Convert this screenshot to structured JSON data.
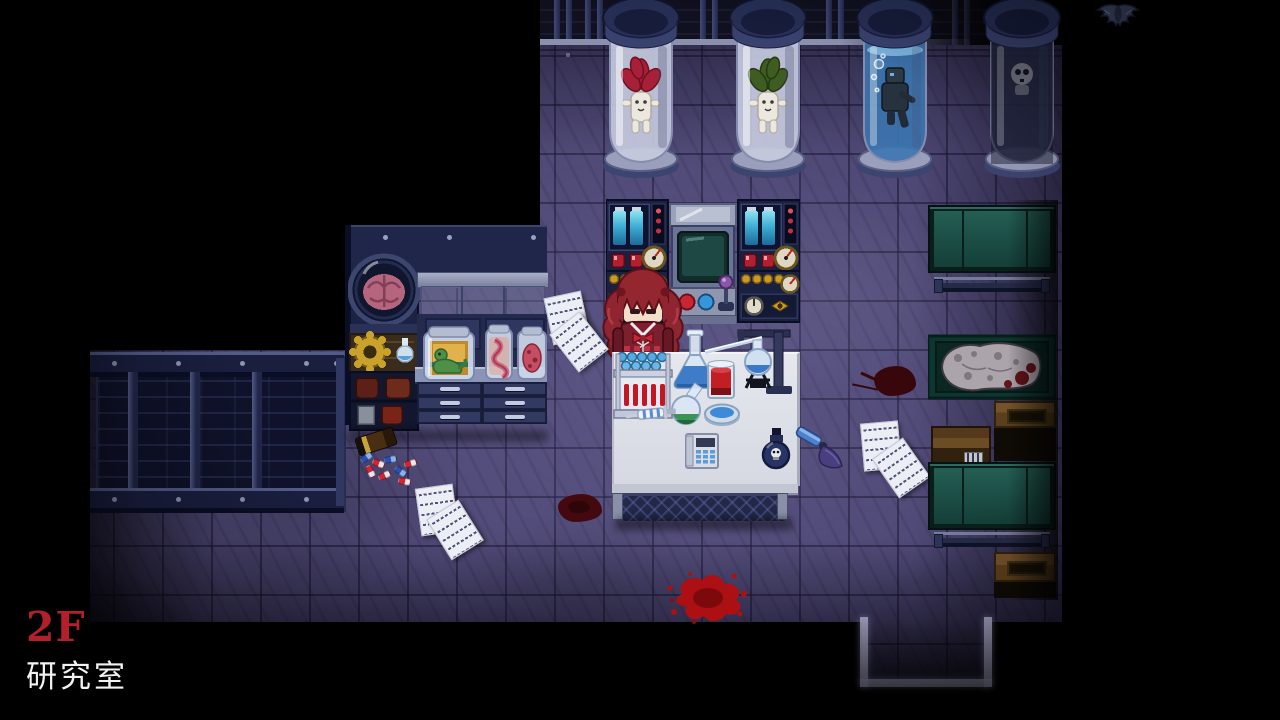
{
  "hud": {
    "floor_label": "2F",
    "room_label": "研究室",
    "floor_label_color": "#b3202a",
    "room_label_color": "#f2f2f2"
  },
  "palette": {
    "background": "#000000",
    "floor_base": "#4e4875",
    "floor_grid": "#2e2a4c",
    "blood_accent": "#ad0f10",
    "cabinet_glass_teal": "#1d5a50",
    "wood_brown": "#6e4a20",
    "specimen_liquid_blue": "#3e78b0",
    "hair_red": "#8e2531",
    "dress_crimson": "#7c2030"
  }
}
